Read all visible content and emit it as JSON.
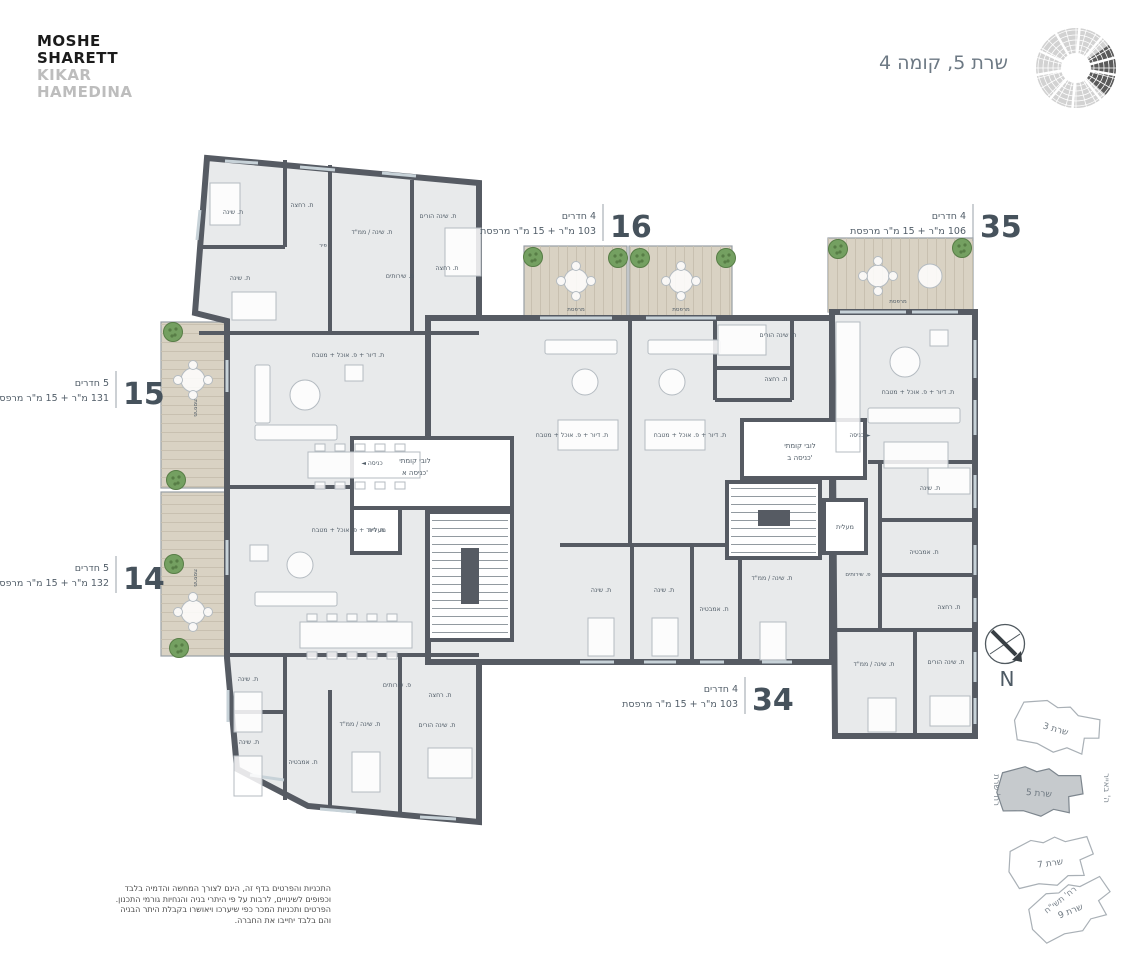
{
  "header": {
    "logo_line1": "MOSHE",
    "logo_line2": "SHARETT",
    "logo_line3": "KIKAR",
    "logo_line4": "HAMEDINA",
    "title": "שרת 5, קומה 4"
  },
  "apartments": [
    {
      "number": "16",
      "rooms": "4 חדרים",
      "area": "103 מ\"ר + 15 מ\"ר מרפסת",
      "x": 603,
      "y": 204
    },
    {
      "number": "35",
      "rooms": "4 חדרים",
      "area": "106 מ\"ר + 15 מ\"ר מרפסת",
      "x": 973,
      "y": 204
    },
    {
      "number": "15",
      "rooms": "5 חדרים",
      "area": "131 מ\"ר + 15 מ\"ר מרפסת",
      "x": 116,
      "y": 371
    },
    {
      "number": "14",
      "rooms": "5 חדרים",
      "area": "132 מ\"ר + 15 מ\"ר מרפסת",
      "x": 116,
      "y": 556
    },
    {
      "number": "34",
      "rooms": "4 חדרים",
      "area": "103 מ\"ר + 15 מ\"ר מרפסת",
      "x": 745,
      "y": 677
    }
  ],
  "plan": {
    "room_labels": [
      {
        "t": "ת. שינה",
        "x": 233,
        "y": 214
      },
      {
        "t": "ת. רחצה",
        "x": 302,
        "y": 207
      },
      {
        "t": "ת. שינה / ממ\"ד",
        "x": 372,
        "y": 234
      },
      {
        "t": "ת. שינה הורים",
        "x": 438,
        "y": 218
      },
      {
        "t": "ת. שינה",
        "x": 240,
        "y": 280
      },
      {
        "t": "פ. שירותים",
        "x": 400,
        "y": 278
      },
      {
        "t": "ת. רחצה",
        "x": 447,
        "y": 270
      },
      {
        "t": "פיר",
        "x": 323,
        "y": 247,
        "s": 5.5
      },
      {
        "t": "ת. דיור + פ. אוכל + מטבח",
        "x": 348,
        "y": 357
      },
      {
        "t": "ת. דיור + פ. אוכל + מטבח",
        "x": 348,
        "y": 532
      },
      {
        "t": "ת. שינה",
        "x": 248,
        "y": 681
      },
      {
        "t": "ת. שינה",
        "x": 249,
        "y": 744
      },
      {
        "t": "ת. אמבטיה",
        "x": 303,
        "y": 764
      },
      {
        "t": "ת. שינה / ממ\"ד",
        "x": 360,
        "y": 726
      },
      {
        "t": "פ. שירותים",
        "x": 397,
        "y": 687
      },
      {
        "t": "ת. רחצה",
        "x": 440,
        "y": 697
      },
      {
        "t": "ת. שינה הורים",
        "x": 437,
        "y": 727
      },
      {
        "t": "ת. שינה הורים",
        "x": 778,
        "y": 337
      },
      {
        "t": "ת. רחצה",
        "x": 776,
        "y": 381
      },
      {
        "t": "ת. דיור + פ. אוכל + מטבח",
        "x": 572,
        "y": 437
      },
      {
        "t": "ת. דיור + פ. אוכל + מטבח",
        "x": 690,
        "y": 437
      },
      {
        "t": "ת. שינה",
        "x": 601,
        "y": 592
      },
      {
        "t": "ת. שינה",
        "x": 664,
        "y": 592
      },
      {
        "t": "ת. אמבטיה",
        "x": 714,
        "y": 611
      },
      {
        "t": "ת. שינה / ממ\"ד",
        "x": 772,
        "y": 580
      },
      {
        "t": "ת. דיור + פ. אוכל + מטבח",
        "x": 918,
        "y": 394
      },
      {
        "t": "ת. שינה",
        "x": 930,
        "y": 490
      },
      {
        "t": "ת. אמבטיה",
        "x": 924,
        "y": 554
      },
      {
        "t": "ת. רחצה",
        "x": 949,
        "y": 609
      },
      {
        "t": "פ. שירותים",
        "x": 858,
        "y": 576,
        "s": 5.5
      },
      {
        "t": "ת. שינה / ממ\"ד",
        "x": 874,
        "y": 666
      },
      {
        "t": "ת. שינה הורים",
        "x": 946,
        "y": 664
      },
      {
        "t": "לובי קומתי",
        "x": 415,
        "y": 463,
        "s": 7
      },
      {
        "t": "כניסה א'",
        "x": 415,
        "y": 475,
        "s": 7
      },
      {
        "t": "לובי קומתי",
        "x": 800,
        "y": 448,
        "s": 7
      },
      {
        "t": "כניסה ב'",
        "x": 800,
        "y": 460,
        "s": 7
      },
      {
        "t": "מעלית",
        "x": 377,
        "y": 532,
        "s": 6.5
      },
      {
        "t": "מעלית",
        "x": 845,
        "y": 529,
        "s": 6.5
      },
      {
        "t": "◄ כניסה",
        "x": 372,
        "y": 465,
        "s": 6
      },
      {
        "t": "כניסה ►",
        "x": 860,
        "y": 437,
        "s": 6
      },
      {
        "t": "מרפסת",
        "x": 194,
        "y": 408,
        "r": 90,
        "s": 5.5
      },
      {
        "t": "מרפסת",
        "x": 194,
        "y": 578,
        "r": 90,
        "s": 5.5
      },
      {
        "t": "מרפסת",
        "x": 576,
        "y": 311,
        "s": 5.5
      },
      {
        "t": "מרפסת",
        "x": 681,
        "y": 311,
        "s": 5.5
      },
      {
        "t": "מרפסת",
        "x": 898,
        "y": 303,
        "s": 5.5
      }
    ],
    "trees": [
      {
        "x": 173,
        "y": 332
      },
      {
        "x": 176,
        "y": 480
      },
      {
        "x": 174,
        "y": 564
      },
      {
        "x": 179,
        "y": 648
      },
      {
        "x": 533,
        "y": 257
      },
      {
        "x": 618,
        "y": 258
      },
      {
        "x": 640,
        "y": 258
      },
      {
        "x": 726,
        "y": 258
      },
      {
        "x": 838,
        "y": 249
      },
      {
        "x": 962,
        "y": 248
      }
    ]
  },
  "keyplan": {
    "north_label": "N",
    "buildings": [
      {
        "label": "שרת 3",
        "x": 1012,
        "y": 702,
        "rot": 16,
        "highlight": false
      },
      {
        "label": "שרת 5",
        "x": 995,
        "y": 766,
        "rot": 5,
        "highlight": true
      },
      {
        "label": "שרת 7",
        "x": 1006,
        "y": 836,
        "rot": -8,
        "highlight": false
      },
      {
        "label": "שרת 9",
        "x": 1026,
        "y": 884,
        "rot": -22,
        "highlight": false
      }
    ],
    "streets": [
      {
        "label": "רח' שרת",
        "x": 994,
        "y": 790,
        "rot": 90
      },
      {
        "label": "ה' באייר",
        "x": 1104,
        "y": 788,
        "rot": 90
      },
      {
        "label": "רח' תשי\"ח",
        "x": 1062,
        "y": 902,
        "rot": -38
      }
    ]
  },
  "disclaimer": {
    "lines": [
      "התכניות והפרטים בדף זה, הינם לצורך המחשה והדמיה בלבד",
      "וכפופים לשינויים, לרבות על פי היתרי בניה והנחיות גורמי התכנון.",
      "הפרטים ותכניות המכר כפי שיערכו ויאושרו בקבלת היתר הבניה",
      "והם בלבד יחייבו את החברה."
    ]
  },
  "colors": {
    "wall": "#565b63",
    "floor": "#e8eaeb",
    "wood": "#d9d2c3",
    "tree_green": "#74a061",
    "tree_dark": "#577d46",
    "label_text": "#4f5b66",
    "number_text": "#46525c",
    "highlight_building": "#c6cacd",
    "window": "#c7d2d8"
  }
}
